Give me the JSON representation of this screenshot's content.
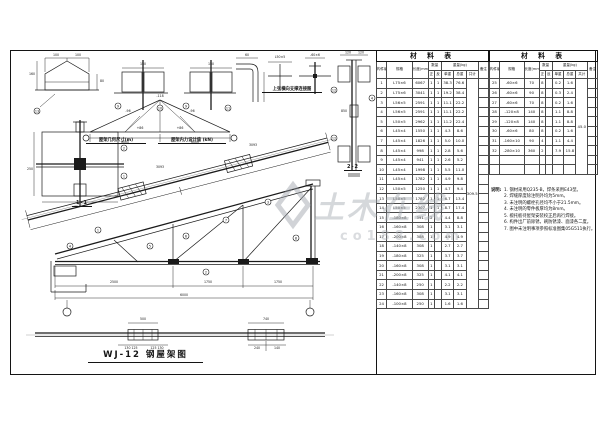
{
  "sheet": {
    "bg": "#ffffff",
    "line_color": "#1a1a1a",
    "watermark_color": "#a4a9b0"
  },
  "watermark": {
    "text": "土木在线",
    "sub": "co188.com"
  },
  "labels": {
    "geometry": "屋架几何尺寸(m)",
    "forces": "屋架内力设计值 (kN)",
    "bracing": "上弦横向支撑连接图",
    "s11": "1-1",
    "s22": "2-2",
    "title": "WJ-12  钢屋架图"
  },
  "tables": {
    "header": {
      "title": "材 料 表",
      "col_no": "构件编号",
      "col_spec": "规格",
      "col_len": "长度(mm)",
      "col_qty": "数量",
      "qty_z": "正",
      "qty_f": "反",
      "col_weight": "重量(kg)",
      "w_unit": "单重",
      "w_total": "总重",
      "w_sum": "共计",
      "col_note": "备注"
    },
    "left": {
      "sum": "309.5",
      "empty": 0,
      "rows": [
        [
          "1",
          "L75×6",
          "6067",
          "1",
          "1",
          "38.3",
          "76.6"
        ],
        [
          "2",
          "L75×6",
          "3041",
          "1",
          "1",
          "19.2",
          "38.4"
        ],
        [
          "3",
          "L56×5",
          "2591",
          "1",
          "1",
          "11.1",
          "22.2"
        ],
        [
          "4",
          "L56×5",
          "2591",
          "1",
          "1",
          "11.1",
          "22.2"
        ],
        [
          "5",
          "L50×5",
          "2962",
          "1",
          "1",
          "11.2",
          "22.4"
        ],
        [
          "6",
          "L45×4",
          "1550",
          "1",
          "1",
          "4.3",
          "8.6"
        ],
        [
          "7",
          "L45×4",
          "1826",
          "1",
          "1",
          "5.0",
          "10.0"
        ],
        [
          "8",
          "L45×4",
          "998",
          "1",
          "1",
          "2.8",
          "5.6"
        ],
        [
          "9",
          "L45×4",
          "941",
          "1",
          "1",
          "2.6",
          "5.2"
        ],
        [
          "10",
          "L45×4",
          "1998",
          "1",
          "1",
          "5.5",
          "11.0"
        ],
        [
          "11",
          "L45×4",
          "1782",
          "1",
          "1",
          "4.9",
          "9.8"
        ],
        [
          "12",
          "L50×5",
          "1250",
          "1",
          "1",
          "4.7",
          "9.4"
        ],
        [
          "13",
          "L50×5",
          "1782",
          "1",
          "1",
          "6.7",
          "13.4"
        ],
        [
          "14",
          "L50×5",
          "2307",
          "1",
          "1",
          "8.7",
          "17.4"
        ],
        [
          "15",
          "-180×8",
          "391",
          "2",
          "",
          "4.4",
          "8.8"
        ],
        [
          "16",
          "-160×8",
          "308",
          "1",
          "",
          "3.1",
          "3.1"
        ],
        [
          "17",
          "-200×8",
          "388",
          "1",
          "",
          "4.9",
          "4.9"
        ],
        [
          "18",
          "-140×8",
          "308",
          "1",
          "",
          "2.7",
          "2.7"
        ],
        [
          "19",
          "-180×8",
          "325",
          "1",
          "",
          "3.7",
          "3.7"
        ],
        [
          "20",
          "-160×8",
          "308",
          "1",
          "",
          "3.1",
          "3.1"
        ],
        [
          "21",
          "-200×8",
          "325",
          "1",
          "",
          "4.1",
          "4.1"
        ],
        [
          "22",
          "-140×8",
          "250",
          "1",
          "",
          "2.2",
          "2.2"
        ],
        [
          "23",
          "-160×8",
          "308",
          "1",
          "",
          "3.1",
          "3.1"
        ],
        [
          "24",
          "-100×8",
          "250",
          "1",
          "",
          "1.6",
          "1.6"
        ]
      ]
    },
    "right": {
      "sum": "45.0",
      "empty": 2,
      "rows": [
        [
          "25",
          "-60×6",
          "70",
          "8",
          "",
          "0.2",
          "1.6"
        ],
        [
          "26",
          "-60×6",
          "90",
          "8",
          "",
          "0.3",
          "2.4"
        ],
        [
          "27",
          "-60×6",
          "70",
          "8",
          "",
          "0.2",
          "1.6"
        ],
        [
          "28",
          "-120×8",
          "140",
          "8",
          "",
          "1.1",
          "8.8"
        ],
        [
          "29",
          "-120×8",
          "140",
          "8",
          "",
          "1.1",
          "8.8"
        ],
        [
          "30",
          "-60×6",
          "80",
          "8",
          "",
          "0.2",
          "1.6"
        ],
        [
          "31",
          "-160×10",
          "90",
          "4",
          "",
          "1.1",
          "4.4"
        ],
        [
          "32",
          "-280×10",
          "360",
          "2",
          "",
          "7.9",
          "15.8"
        ]
      ]
    }
  },
  "notes": {
    "heading": "说明:",
    "lines": [
      "1. 钢材采用Q235-B，焊条采用E43型。",
      "2. 焊缝厚度除注明外均为5mm。",
      "3. 未注明的螺栓孔径均不小于21.5mm。",
      "4. 未注明的零件板厚均为8mm。",
      "5. 檩托板待屋架安装校正后再行焊接。",
      "6. 构件出厂前除锈，刷防锈漆、面漆各二度。",
      "7. 图中未注明事项参照标准图集05G511执行。"
    ]
  },
  "dims": [
    {
      "x": 46,
      "y": 6,
      "t": "100"
    },
    {
      "x": 68,
      "y": 6,
      "t": "100"
    },
    {
      "x": 22,
      "y": 25,
      "t": "160"
    },
    {
      "x": 92,
      "y": 32,
      "t": "80"
    },
    {
      "x": 133,
      "y": 15,
      "t": "150"
    },
    {
      "x": 201,
      "y": 15,
      "t": "150"
    },
    {
      "x": 237,
      "y": 6,
      "t": "60"
    },
    {
      "x": 270,
      "y": 8,
      "t": "L50×5"
    },
    {
      "x": 305,
      "y": 6,
      "t": "-60×6"
    },
    {
      "x": 338,
      "y": 3.5,
      "t": "120"
    },
    {
      "x": 351,
      "y": 3.5,
      "t": "120"
    },
    {
      "x": 334,
      "y": 62,
      "t": "850"
    },
    {
      "x": 20,
      "y": 120,
      "t": "250"
    },
    {
      "x": 115,
      "y": 93,
      "t": "6000"
    },
    {
      "x": 185,
      "y": 93,
      "t": "6000"
    },
    {
      "x": 150,
      "y": 47,
      "t": "-118"
    },
    {
      "x": 118,
      "y": 62,
      "t": "-96"
    },
    {
      "x": 182,
      "y": 62,
      "t": "-96"
    },
    {
      "x": 130,
      "y": 79,
      "t": "+86"
    },
    {
      "x": 170,
      "y": 79,
      "t": "+86"
    },
    {
      "x": 150,
      "y": 118,
      "t": "3093"
    },
    {
      "x": 243,
      "y": 96,
      "t": "3093"
    },
    {
      "x": 104,
      "y": 233,
      "t": "2500"
    },
    {
      "x": 198,
      "y": 233,
      "t": "1750"
    },
    {
      "x": 268,
      "y": 233,
      "t": "1750"
    },
    {
      "x": 174,
      "y": 246,
      "t": "6000"
    },
    {
      "x": 133,
      "y": 270,
      "t": "500"
    },
    {
      "x": 256,
      "y": 270,
      "t": "740"
    },
    {
      "x": 121,
      "y": 299,
      "t": "130 125"
    },
    {
      "x": 147,
      "y": 299,
      "t": "125 130"
    },
    {
      "x": 247,
      "y": 299,
      "t": "240"
    },
    {
      "x": 267,
      "y": 299,
      "t": "140"
    }
  ],
  "balloons": [
    {
      "x": 27,
      "y": 61,
      "n": "13"
    },
    {
      "x": 108,
      "y": 56,
      "n": "9"
    },
    {
      "x": 150,
      "y": 58,
      "n": "10"
    },
    {
      "x": 176,
      "y": 56,
      "n": "9"
    },
    {
      "x": 218,
      "y": 58,
      "n": "11"
    },
    {
      "x": 324,
      "y": 40,
      "n": "12"
    },
    {
      "x": 362,
      "y": 48,
      "n": "4"
    },
    {
      "x": 324,
      "y": 88,
      "n": "12"
    },
    {
      "x": 114,
      "y": 98,
      "n": "2"
    },
    {
      "x": 114,
      "y": 126,
      "n": "1"
    },
    {
      "x": 88,
      "y": 180,
      "n": "1"
    },
    {
      "x": 140,
      "y": 196,
      "n": "5"
    },
    {
      "x": 176,
      "y": 186,
      "n": "6"
    },
    {
      "x": 216,
      "y": 170,
      "n": "7"
    },
    {
      "x": 258,
      "y": 152,
      "n": "3"
    },
    {
      "x": 286,
      "y": 188,
      "n": "8"
    },
    {
      "x": 196,
      "y": 222,
      "n": "2"
    },
    {
      "x": 60,
      "y": 196,
      "n": "4"
    }
  ]
}
